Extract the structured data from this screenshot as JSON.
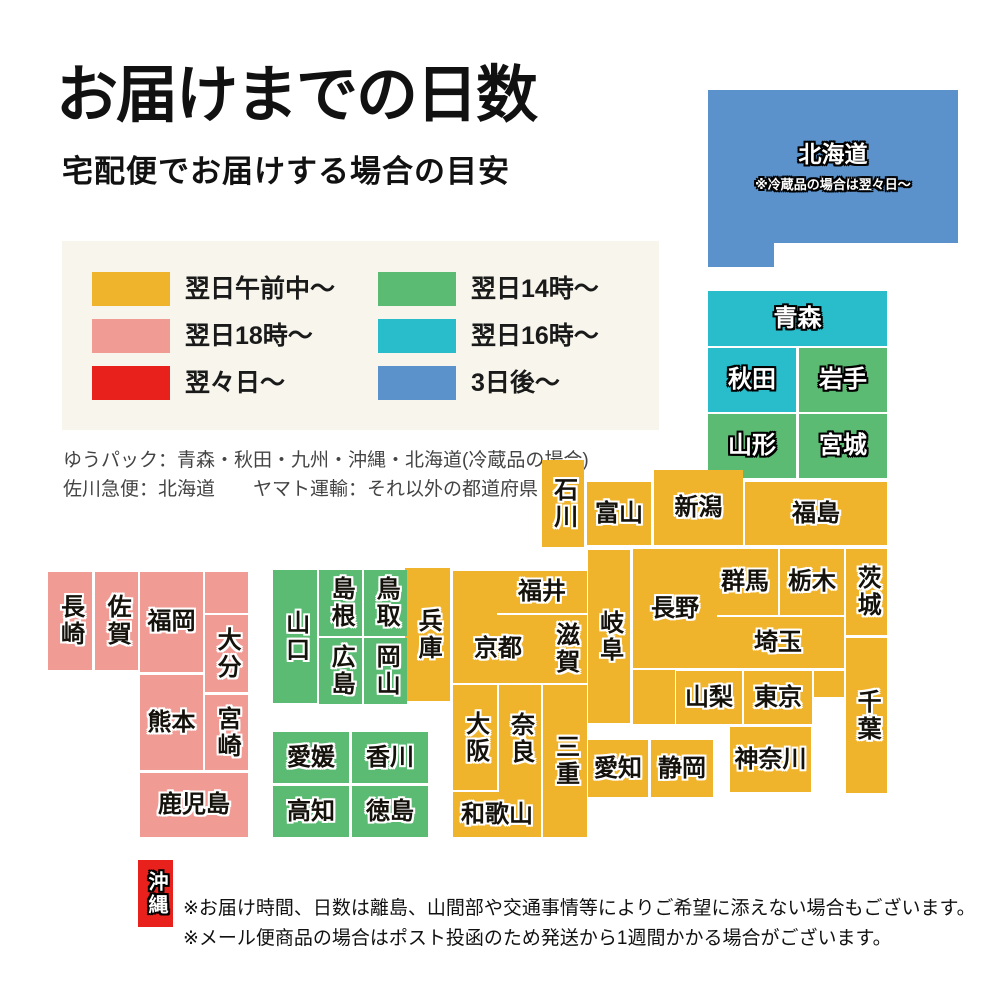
{
  "header": {
    "title": "お届けまでの日数",
    "subtitle": "宅配便でお届けする場合の目安"
  },
  "legend": {
    "items": [
      {
        "label": "翌日午前中〜",
        "color": "#f0b42c"
      },
      {
        "label": "翌日18時〜",
        "color": "#f09c95"
      },
      {
        "label": "翌々日〜",
        "color": "#e8211d"
      },
      {
        "label": "翌日14時〜",
        "color": "#5cbb73"
      },
      {
        "label": "翌日16時〜",
        "color": "#29bccb"
      },
      {
        "label": "3日後〜",
        "color": "#5b92cb"
      }
    ]
  },
  "carriers": {
    "line1": "ゆうパック：青森・秋田・九州・沖縄・北海道(冷蔵品の場合)",
    "line2": "佐川急便：北海道　　ヤマト運輸：それ以外の都道府県"
  },
  "palette": {
    "yellow": "#f0b42c",
    "pink": "#f09c95",
    "red": "#e8211d",
    "green": "#5cbb73",
    "teal": "#29bccb",
    "blue": "#5b92cb"
  },
  "map": {
    "prefectures": [
      {
        "id": "hokkaido",
        "label": "北海道",
        "note": "※冷蔵品の場合は翌々日〜",
        "color": "blue",
        "x": 708,
        "y": 90,
        "w": 250,
        "h": 153,
        "v": false,
        "style": "light",
        "fs": 23
      },
      {
        "id": "hokkaido-ext",
        "label": "",
        "color": "blue",
        "x": 708,
        "y": 243,
        "w": 66,
        "h": 24
      },
      {
        "id": "aomori",
        "label": "青森",
        "color": "teal",
        "x": 708,
        "y": 291,
        "w": 179,
        "h": 55,
        "v": false,
        "style": "light"
      },
      {
        "id": "akita",
        "label": "秋田",
        "color": "teal",
        "x": 708,
        "y": 348,
        "w": 88,
        "h": 64,
        "v": false,
        "style": "light"
      },
      {
        "id": "iwate",
        "label": "岩手",
        "color": "green",
        "x": 799,
        "y": 348,
        "w": 88,
        "h": 64,
        "v": false,
        "style": "light"
      },
      {
        "id": "yamagata",
        "label": "山形",
        "color": "green",
        "x": 708,
        "y": 414,
        "w": 88,
        "h": 64,
        "v": false,
        "style": "light"
      },
      {
        "id": "miyagi",
        "label": "宮城",
        "color": "green",
        "x": 799,
        "y": 414,
        "w": 88,
        "h": 64,
        "v": false,
        "style": "light"
      },
      {
        "id": "fukushima",
        "label": "福島",
        "color": "yellow",
        "x": 745,
        "y": 482,
        "w": 142,
        "h": 63,
        "v": false,
        "style": "dark"
      },
      {
        "id": "niigata",
        "label": "新潟",
        "color": "yellow",
        "x": 654,
        "y": 470,
        "w": 89,
        "h": 75,
        "v": false,
        "style": "dark"
      },
      {
        "id": "toyama",
        "label": "富山",
        "color": "yellow",
        "x": 587,
        "y": 482,
        "w": 64,
        "h": 63,
        "v": false,
        "style": "dark"
      },
      {
        "id": "ishikawa",
        "label": "石川",
        "color": "yellow",
        "x": 542,
        "y": 460,
        "w": 42,
        "h": 87,
        "v": true,
        "style": "dark"
      },
      {
        "id": "gunma",
        "label": "群馬",
        "color": "yellow",
        "x": 712,
        "y": 549,
        "w": 66,
        "h": 66,
        "v": false,
        "style": "dark"
      },
      {
        "id": "tochigi",
        "label": "栃木",
        "color": "yellow",
        "x": 780,
        "y": 549,
        "w": 64,
        "h": 66,
        "v": false,
        "style": "dark"
      },
      {
        "id": "ibaraki",
        "label": "茨城",
        "color": "yellow",
        "x": 846,
        "y": 549,
        "w": 41,
        "h": 86,
        "v": true,
        "style": "dark"
      },
      {
        "id": "saitama",
        "label": "埼玉",
        "color": "yellow",
        "x": 712,
        "y": 617,
        "w": 132,
        "h": 51,
        "v": false,
        "style": "dark"
      },
      {
        "id": "yamanashi",
        "label": "山梨",
        "color": "yellow",
        "x": 676,
        "y": 671,
        "w": 66,
        "h": 53,
        "v": false,
        "style": "dark"
      },
      {
        "id": "tokyo",
        "label": "東京",
        "color": "yellow",
        "x": 744,
        "y": 671,
        "w": 68,
        "h": 53,
        "v": false,
        "style": "dark"
      },
      {
        "id": "tokyo-ext",
        "label": "",
        "color": "yellow",
        "x": 814,
        "y": 671,
        "w": 30,
        "h": 26
      },
      {
        "id": "chiba",
        "label": "千葉",
        "color": "yellow",
        "x": 846,
        "y": 638,
        "w": 41,
        "h": 155,
        "v": true,
        "style": "dark"
      },
      {
        "id": "kanagawa",
        "label": "神奈川",
        "color": "yellow",
        "x": 730,
        "y": 727,
        "w": 81,
        "h": 65,
        "v": false,
        "style": "dark"
      },
      {
        "id": "nagano",
        "label": "長野",
        "color": "yellow",
        "x": 633,
        "y": 549,
        "w": 84,
        "h": 119,
        "v": false,
        "style": "dark"
      },
      {
        "id": "nagano-ext",
        "label": "",
        "color": "yellow",
        "x": 633,
        "y": 670,
        "w": 42,
        "h": 54
      },
      {
        "id": "gifu",
        "label": "岐阜",
        "color": "yellow",
        "x": 588,
        "y": 550,
        "w": 42,
        "h": 173,
        "v": true,
        "style": "dark"
      },
      {
        "id": "fukui",
        "label": "福井",
        "color": "yellow",
        "x": 497,
        "y": 571,
        "w": 90,
        "h": 42,
        "v": false,
        "style": "dark"
      },
      {
        "id": "kyoto",
        "label": "京都",
        "color": "yellow",
        "x": 453,
        "y": 615,
        "w": 90,
        "h": 68,
        "v": false,
        "style": "dark"
      },
      {
        "id": "kyoto-ext",
        "label": "",
        "color": "yellow",
        "x": 453,
        "y": 571,
        "w": 44,
        "h": 46
      },
      {
        "id": "shiga",
        "label": "滋賀",
        "color": "yellow",
        "x": 543,
        "y": 615,
        "w": 44,
        "h": 68,
        "v": true,
        "style": "dark"
      },
      {
        "id": "hyogo",
        "label": "兵庫",
        "color": "yellow",
        "x": 405,
        "y": 568,
        "w": 45,
        "h": 133,
        "v": true,
        "style": "dark"
      },
      {
        "id": "osaka",
        "label": "大阪",
        "color": "yellow",
        "x": 453,
        "y": 685,
        "w": 44,
        "h": 105,
        "v": true,
        "style": "dark"
      },
      {
        "id": "nara",
        "label": "奈良",
        "color": "yellow",
        "x": 499,
        "y": 685,
        "w": 42,
        "h": 108,
        "v": true,
        "style": "dark"
      },
      {
        "id": "mie",
        "label": "三重",
        "color": "yellow",
        "x": 543,
        "y": 685,
        "w": 44,
        "h": 152,
        "v": true,
        "style": "dark"
      },
      {
        "id": "wakayama",
        "label": "和歌山",
        "color": "yellow",
        "x": 453,
        "y": 792,
        "w": 88,
        "h": 45,
        "v": false,
        "style": "dark"
      },
      {
        "id": "aichi",
        "label": "愛知",
        "color": "yellow",
        "x": 588,
        "y": 740,
        "w": 60,
        "h": 57,
        "v": false,
        "style": "dark"
      },
      {
        "id": "shizuoka",
        "label": "静岡",
        "color": "yellow",
        "x": 651,
        "y": 740,
        "w": 62,
        "h": 57,
        "v": false,
        "style": "dark"
      },
      {
        "id": "yamaguchi",
        "label": "山口",
        "color": "green",
        "x": 273,
        "y": 570,
        "w": 44,
        "h": 133,
        "v": true,
        "style": "dark"
      },
      {
        "id": "shimane",
        "label": "島根",
        "color": "green",
        "x": 319,
        "y": 570,
        "w": 43,
        "h": 66,
        "v": true,
        "style": "dark"
      },
      {
        "id": "tottori",
        "label": "鳥取",
        "color": "green",
        "x": 364,
        "y": 570,
        "w": 43,
        "h": 66,
        "v": true,
        "style": "dark"
      },
      {
        "id": "hiroshima",
        "label": "広島",
        "color": "green",
        "x": 319,
        "y": 638,
        "w": 43,
        "h": 66,
        "v": true,
        "style": "dark"
      },
      {
        "id": "okayama",
        "label": "岡山",
        "color": "green",
        "x": 364,
        "y": 638,
        "w": 43,
        "h": 66,
        "v": true,
        "style": "dark"
      },
      {
        "id": "ehime",
        "label": "愛媛",
        "color": "green",
        "x": 273,
        "y": 732,
        "w": 76,
        "h": 51,
        "v": false,
        "style": "dark"
      },
      {
        "id": "kagawa",
        "label": "香川",
        "color": "green",
        "x": 352,
        "y": 732,
        "w": 76,
        "h": 51,
        "v": false,
        "style": "dark"
      },
      {
        "id": "kochi",
        "label": "高知",
        "color": "green",
        "x": 273,
        "y": 786,
        "w": 76,
        "h": 51,
        "v": false,
        "style": "dark"
      },
      {
        "id": "tokushima",
        "label": "徳島",
        "color": "green",
        "x": 352,
        "y": 786,
        "w": 76,
        "h": 51,
        "v": false,
        "style": "dark"
      },
      {
        "id": "nagasaki",
        "label": "長崎",
        "color": "pink",
        "x": 48,
        "y": 572,
        "w": 44,
        "h": 98,
        "v": true,
        "style": "dark"
      },
      {
        "id": "saga",
        "label": "佐賀",
        "color": "pink",
        "x": 95,
        "y": 572,
        "w": 43,
        "h": 98,
        "v": true,
        "style": "dark"
      },
      {
        "id": "fukuoka",
        "label": "福岡",
        "color": "pink",
        "x": 140,
        "y": 572,
        "w": 63,
        "h": 100,
        "v": false,
        "style": "dark"
      },
      {
        "id": "fukuoka-ext",
        "label": "",
        "color": "pink",
        "x": 205,
        "y": 572,
        "w": 43,
        "h": 41
      },
      {
        "id": "oita",
        "label": "大分",
        "color": "pink",
        "x": 205,
        "y": 615,
        "w": 43,
        "h": 77,
        "v": true,
        "style": "dark"
      },
      {
        "id": "kumamoto",
        "label": "熊本",
        "color": "pink",
        "x": 140,
        "y": 675,
        "w": 63,
        "h": 95,
        "v": false,
        "style": "dark"
      },
      {
        "id": "miyazaki",
        "label": "宮崎",
        "color": "pink",
        "x": 205,
        "y": 695,
        "w": 43,
        "h": 75,
        "v": true,
        "style": "dark"
      },
      {
        "id": "kagoshima",
        "label": "鹿児島",
        "color": "pink",
        "x": 140,
        "y": 773,
        "w": 108,
        "h": 64,
        "v": false,
        "style": "dark"
      },
      {
        "id": "okinawa",
        "label": "沖縄",
        "color": "red",
        "x": 138,
        "y": 860,
        "w": 35,
        "h": 67,
        "v": true,
        "style": "light",
        "fs": 20
      }
    ]
  },
  "notes": {
    "line1": "※お届け時間、日数は離島、山間部や交通事情等によりご希望に添えない場合もございます。",
    "line2": "※メール便商品の場合はポスト投函のため発送から1週間かかる場合がございます。"
  }
}
